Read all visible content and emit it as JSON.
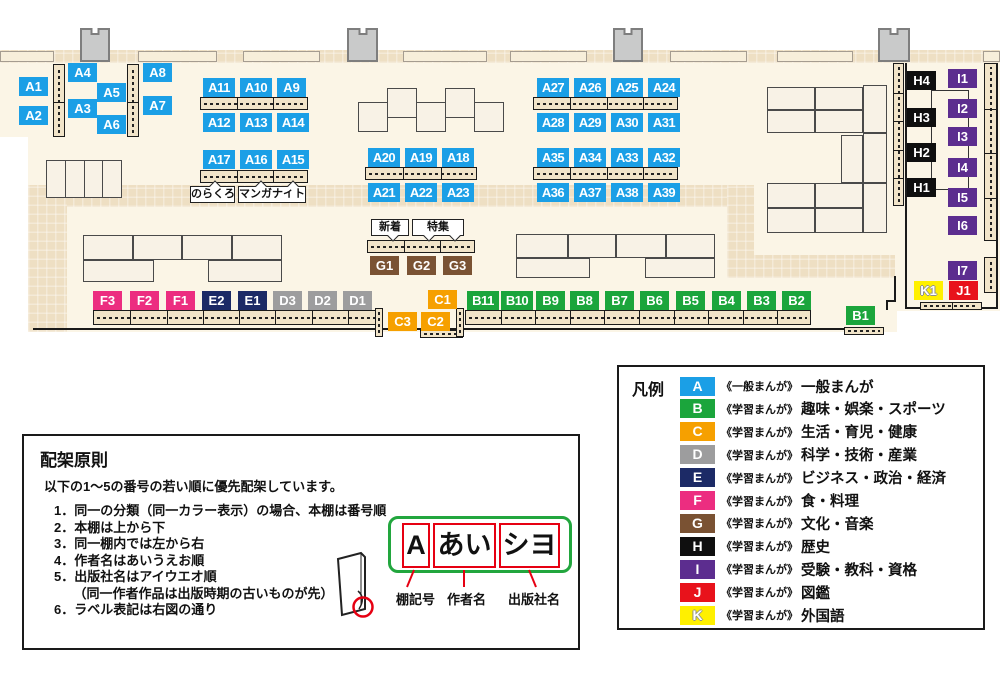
{
  "map": {
    "group_colors": {
      "A": "#1B9FE6",
      "B": "#1BA53C",
      "C": "#F6A000",
      "D": "#9D9D9E",
      "E": "#1C2A66",
      "F": "#EC2D80",
      "G": "#7A5233",
      "H": "#0F0F0F",
      "I": "#5C2D8F",
      "J": "#E8121B",
      "K": "#FFF000"
    },
    "outlined_groups": [
      "K"
    ],
    "floor": [
      [
        0,
        50,
        1000,
        87
      ],
      [
        28,
        137,
        869,
        195
      ],
      [
        897,
        137,
        103,
        174
      ]
    ],
    "walkways": [
      [
        0,
        50,
        1000,
        13
      ],
      [
        28,
        185,
        726,
        22
      ],
      [
        727,
        185,
        27,
        93
      ],
      [
        727,
        255,
        168,
        23
      ],
      [
        28,
        185,
        39,
        147
      ]
    ],
    "wall_shelves": [
      [
        0,
        51,
        54,
        11
      ],
      [
        138,
        51,
        79,
        11
      ],
      [
        243,
        51,
        77,
        11
      ],
      [
        403,
        51,
        84,
        11
      ],
      [
        510,
        51,
        77,
        11
      ],
      [
        670,
        51,
        77,
        11
      ],
      [
        777,
        51,
        76,
        11
      ],
      [
        983,
        51,
        17,
        11
      ]
    ],
    "pillars": [
      [
        80,
        28,
        30,
        34
      ],
      [
        347,
        28,
        31,
        34
      ],
      [
        613,
        28,
        30,
        34
      ],
      [
        878,
        28,
        32,
        34
      ]
    ],
    "wall_lines": [
      [
        33,
        328,
        850,
        2
      ],
      [
        905,
        63,
        2,
        246
      ],
      [
        905,
        307,
        93,
        2
      ],
      [
        996,
        63,
        2,
        246
      ],
      [
        894,
        276,
        2,
        26
      ],
      [
        886,
        300,
        10,
        2
      ],
      [
        886,
        300,
        2,
        10
      ]
    ],
    "unit_outlines": [
      [
        931,
        90,
        38,
        100
      ]
    ],
    "tables": [
      [
        46,
        160,
        76,
        38,
        4
      ],
      [
        358,
        102,
        30,
        30
      ],
      [
        387,
        88,
        30,
        30
      ],
      [
        416,
        102,
        30,
        30
      ],
      [
        445,
        88,
        30,
        30
      ],
      [
        474,
        102,
        30,
        30
      ],
      [
        83,
        235,
        50,
        25
      ],
      [
        133,
        235,
        49,
        25
      ],
      [
        182,
        235,
        50,
        25
      ],
      [
        232,
        235,
        50,
        25
      ],
      [
        83,
        260,
        71,
        22
      ],
      [
        208,
        260,
        74,
        22
      ],
      [
        516,
        234,
        52,
        24
      ],
      [
        568,
        234,
        48,
        24
      ],
      [
        616,
        234,
        50,
        24
      ],
      [
        666,
        234,
        49,
        24
      ],
      [
        516,
        258,
        74,
        20
      ],
      [
        645,
        258,
        70,
        20
      ],
      [
        767,
        87,
        48,
        23
      ],
      [
        815,
        87,
        48,
        23
      ],
      [
        767,
        110,
        48,
        23
      ],
      [
        815,
        110,
        48,
        23
      ],
      [
        863,
        85,
        24,
        48
      ],
      [
        841,
        135,
        22,
        48
      ],
      [
        863,
        133,
        24,
        50
      ],
      [
        767,
        183,
        48,
        25
      ],
      [
        815,
        183,
        48,
        25
      ],
      [
        767,
        208,
        48,
        25
      ],
      [
        815,
        208,
        48,
        25
      ],
      [
        863,
        183,
        24,
        50
      ]
    ],
    "shelves": [
      [
        200,
        97,
        108,
        13,
        "h",
        3
      ],
      [
        200,
        170,
        108,
        13,
        "h",
        3
      ],
      [
        365,
        167,
        112,
        13,
        "h",
        3
      ],
      [
        533,
        97,
        145,
        13,
        "h",
        4
      ],
      [
        533,
        167,
        145,
        13,
        "h",
        4
      ],
      [
        367,
        240,
        108,
        13,
        "h",
        3
      ],
      [
        93,
        310,
        290,
        15,
        "h",
        8
      ],
      [
        465,
        310,
        346,
        15,
        "h",
        10
      ],
      [
        920,
        302,
        62,
        8,
        "h",
        2
      ],
      [
        844,
        327,
        40,
        8,
        "h",
        1
      ],
      [
        420,
        330,
        43,
        8,
        "h",
        1
      ],
      [
        53,
        64,
        12,
        73,
        "v",
        2
      ],
      [
        127,
        64,
        12,
        73,
        "v",
        2
      ],
      [
        375,
        308,
        8,
        29,
        "v",
        1
      ],
      [
        456,
        308,
        8,
        29,
        "v",
        1
      ],
      [
        893,
        63,
        11,
        143,
        "v",
        5
      ],
      [
        984,
        63,
        13,
        178,
        "v",
        4
      ],
      [
        984,
        257,
        13,
        36,
        "v",
        1
      ]
    ],
    "labels": [
      [
        "A1",
        19,
        77
      ],
      [
        "A2",
        19,
        106
      ],
      [
        "A4",
        68,
        63
      ],
      [
        "A3",
        68,
        99
      ],
      [
        "A5",
        97,
        83
      ],
      [
        "A6",
        97,
        115
      ],
      [
        "A8",
        143,
        63
      ],
      [
        "A7",
        143,
        96
      ],
      [
        "A11",
        203,
        78
      ],
      [
        "A10",
        240,
        78
      ],
      [
        "A9",
        277,
        78
      ],
      [
        "A12",
        203,
        113
      ],
      [
        "A13",
        240,
        113
      ],
      [
        "A14",
        277,
        113
      ],
      [
        "A17",
        203,
        150
      ],
      [
        "A16",
        240,
        150
      ],
      [
        "A15",
        277,
        150
      ],
      [
        "A20",
        368,
        148
      ],
      [
        "A19",
        405,
        148
      ],
      [
        "A18",
        442,
        148
      ],
      [
        "A21",
        368,
        183
      ],
      [
        "A22",
        405,
        183
      ],
      [
        "A23",
        442,
        183
      ],
      [
        "A27",
        537,
        78
      ],
      [
        "A26",
        574,
        78
      ],
      [
        "A25",
        611,
        78
      ],
      [
        "A24",
        648,
        78
      ],
      [
        "A28",
        537,
        113
      ],
      [
        "A29",
        574,
        113
      ],
      [
        "A30",
        611,
        113
      ],
      [
        "A31",
        648,
        113
      ],
      [
        "A35",
        537,
        148
      ],
      [
        "A34",
        574,
        148
      ],
      [
        "A33",
        611,
        148
      ],
      [
        "A32",
        648,
        148
      ],
      [
        "A36",
        537,
        183
      ],
      [
        "A37",
        574,
        183
      ],
      [
        "A38",
        611,
        183
      ],
      [
        "A39",
        648,
        183
      ],
      [
        "G1",
        370,
        256
      ],
      [
        "G2",
        407,
        256
      ],
      [
        "G3",
        443,
        256
      ],
      [
        "F3",
        93,
        291
      ],
      [
        "F2",
        130,
        291
      ],
      [
        "F1",
        166,
        291
      ],
      [
        "E2",
        202,
        291
      ],
      [
        "E1",
        238,
        291
      ],
      [
        "D3",
        273,
        291
      ],
      [
        "D2",
        308,
        291
      ],
      [
        "D1",
        343,
        291
      ],
      [
        "C1",
        428,
        290
      ],
      [
        "C3",
        388,
        312
      ],
      [
        "C2",
        421,
        312
      ],
      [
        "B11",
        467,
        291
      ],
      [
        "B10",
        501,
        291
      ],
      [
        "B9",
        536,
        291
      ],
      [
        "B8",
        570,
        291
      ],
      [
        "B7",
        605,
        291
      ],
      [
        "B6",
        640,
        291
      ],
      [
        "B5",
        676,
        291
      ],
      [
        "B4",
        712,
        291
      ],
      [
        "B3",
        747,
        291
      ],
      [
        "B2",
        782,
        291
      ],
      [
        "B1",
        846,
        306
      ],
      [
        "H4",
        907,
        71
      ],
      [
        "H3",
        907,
        108
      ],
      [
        "H2",
        907,
        143
      ],
      [
        "H1",
        907,
        178
      ],
      [
        "I1",
        948,
        69
      ],
      [
        "I2",
        948,
        99
      ],
      [
        "I3",
        948,
        127
      ],
      [
        "I4",
        948,
        158
      ],
      [
        "I5",
        948,
        188
      ],
      [
        "I6",
        948,
        216
      ],
      [
        "I7",
        948,
        261
      ],
      [
        "K1",
        914,
        281
      ],
      [
        "J1",
        949,
        281
      ]
    ],
    "callouts": [
      {
        "text": "のらくろ",
        "x": 190,
        "y": 186,
        "w": 45,
        "h": 17,
        "dir": "up",
        "tails": [
          20
        ]
      },
      {
        "text": "マンガナイト",
        "x": 238,
        "y": 186,
        "w": 68,
        "h": 17,
        "dir": "up",
        "tails": [
          18,
          50
        ]
      },
      {
        "text": "新着",
        "x": 371,
        "y": 219,
        "w": 38,
        "h": 17,
        "dir": "down",
        "tails": [
          17
        ]
      },
      {
        "text": "特集",
        "x": 412,
        "y": 219,
        "w": 52,
        "h": 17,
        "dir": "down",
        "tails": [
          12,
          38
        ]
      }
    ]
  },
  "legend": {
    "title": "凡例",
    "items": [
      {
        "letter": "A",
        "color": "#1B9FE6",
        "series": "《一般まんが》",
        "category": "一般まんが"
      },
      {
        "letter": "B",
        "color": "#1BA53C",
        "series": "《学習まんが》",
        "category": "趣味・娯楽・スポーツ"
      },
      {
        "letter": "C",
        "color": "#F6A000",
        "series": "《学習まんが》",
        "category": "生活・育児・健康"
      },
      {
        "letter": "D",
        "color": "#9D9D9E",
        "series": "《学習まんが》",
        "category": "科学・技術・産業"
      },
      {
        "letter": "E",
        "color": "#1C2A66",
        "series": "《学習まんが》",
        "category": "ビジネス・政治・経済"
      },
      {
        "letter": "F",
        "color": "#EC2D80",
        "series": "《学習まんが》",
        "category": "食・料理"
      },
      {
        "letter": "G",
        "color": "#7A5233",
        "series": "《学習まんが》",
        "category": "文化・音楽"
      },
      {
        "letter": "H",
        "color": "#0F0F0F",
        "series": "《学習まんが》",
        "category": "歴史"
      },
      {
        "letter": "I",
        "color": "#5C2D8F",
        "series": "《学習まんが》",
        "category": "受験・教科・資格"
      },
      {
        "letter": "J",
        "color": "#E8121B",
        "series": "《学習まんが》",
        "category": "図鑑"
      },
      {
        "letter": "K",
        "color": "#FFF000",
        "series": "《学習まんが》",
        "category": "外国語",
        "outline": true
      }
    ]
  },
  "principles": {
    "title": "配架原則",
    "intro": "以下の1～5の番号の若い順に優先配架しています。",
    "items": [
      "1．同一の分類（同一カラー表示）の場合、本棚は番号順",
      "2．本棚は上から下",
      "3．同一棚内では左から右",
      "4．作者名はあいうえお順",
      "5．出版社名はアイウエオ順",
      "　　（同一作者作品は出版時期の古いものが先）",
      "6．ラベル表記は右図の通り"
    ]
  },
  "label_diagram": {
    "boxes": [
      {
        "text": "A",
        "x": 402,
        "y": 523,
        "w": 28,
        "h": 45
      },
      {
        "text": "あい",
        "x": 433,
        "y": 523,
        "w": 63,
        "h": 45
      },
      {
        "text": "シヨ",
        "x": 499,
        "y": 523,
        "w": 61,
        "h": 45
      }
    ],
    "captions": [
      {
        "text": "棚記号",
        "x": 396,
        "y": 589
      },
      {
        "text": "作者名",
        "x": 447,
        "y": 589
      },
      {
        "text": "出版社名",
        "x": 508,
        "y": 589
      }
    ]
  }
}
